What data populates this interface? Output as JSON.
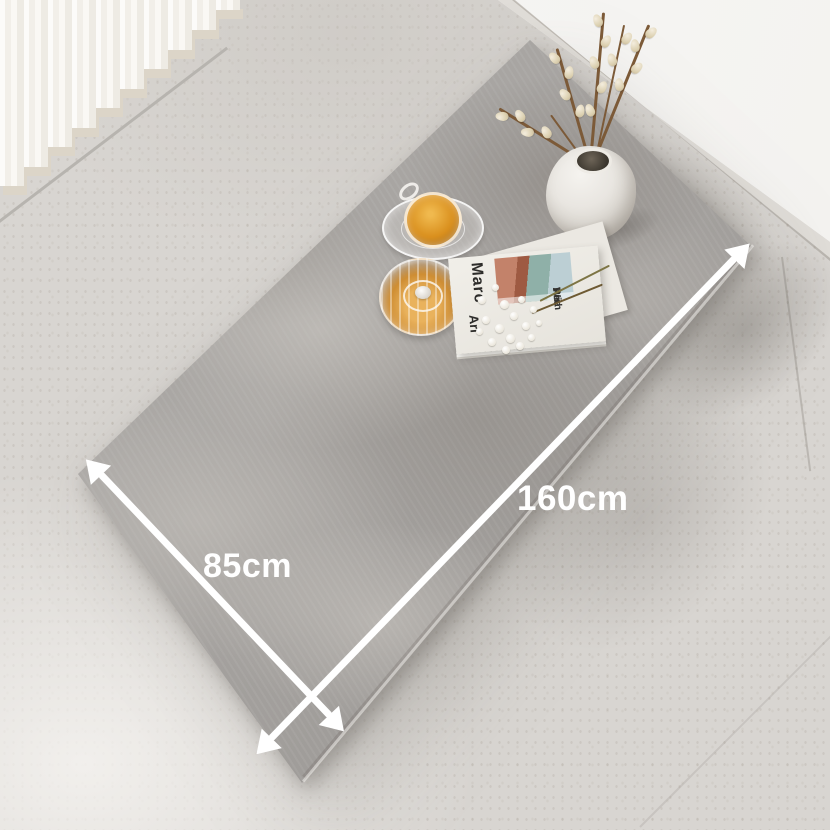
{
  "scene": {
    "description": "Angled top-down product photo of a rectangular dining table with a gray marble-plaster top, standing on a concrete floor against a white wall with white vertical blinds",
    "table": {
      "length_label": "160cm",
      "width_label": "85cm",
      "surface": "gray marble / plaster pattern"
    },
    "annotations": {
      "arrow_color": "#ffffff",
      "label_color": "#ffffff"
    },
    "props": {
      "vase": "white stone vase with pussy-willow branches",
      "cup": "glass cup of amber tea on glass saucer",
      "pot": "ribbed glass teapot with amber tea",
      "magazine": {
        "texts": [
          "Marc",
          "Ari",
          "With",
          "Ari",
          "Rea"
        ]
      },
      "flowers": "white gypsophila sprig"
    },
    "colors": {
      "floor": "#d8d5d1",
      "wall": "#f5f4f1",
      "table": "#a6a3a0",
      "shadow": "#b3b0ac",
      "tea_amber": "#d98f1d",
      "blinds": "#f8f6f2"
    }
  }
}
